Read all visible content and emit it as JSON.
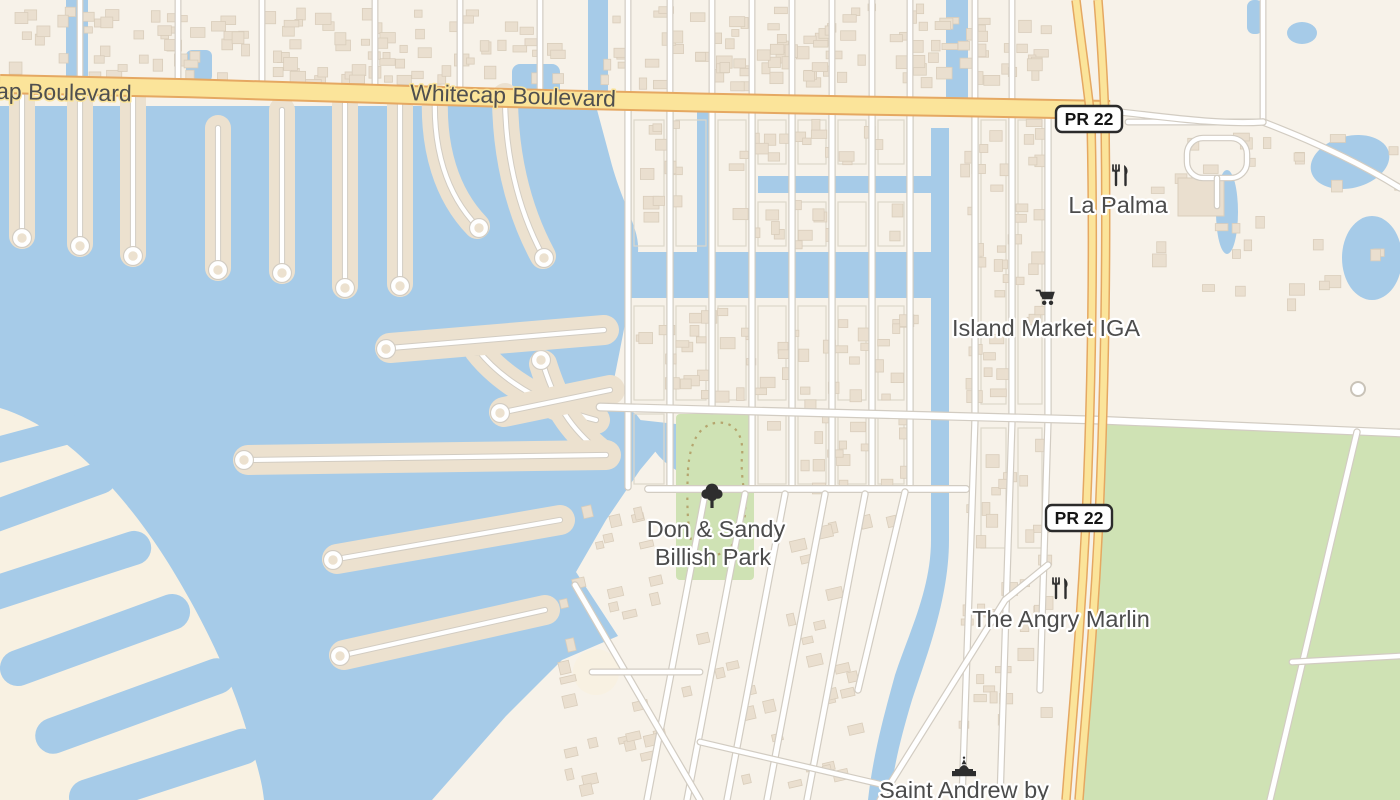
{
  "colors": {
    "water": "#a6cbe8",
    "wave": "#88aed2",
    "land": "#f7f2e9",
    "land_finger": "#ece1cf",
    "land_sand": "#f8f1e2",
    "building": "#eadfcf",
    "building_stroke": "#d9cdbb",
    "block_stroke": "#ddd7ca",
    "street": "#ffffff",
    "street_casing": "#d2ccc2",
    "highway": "#fbe49a",
    "highway_casing": "#e5a862",
    "green": "#cfe2b4",
    "trail": "#b09a62",
    "label": "#4c4c4c",
    "shield_bg": "#ffffff",
    "shield_border": "#2b2b2b",
    "icon": "#2e2e2e"
  },
  "street_labels": {
    "whitecap_partial": "ap Boulevard",
    "whitecap": "Whitecap Boulevard"
  },
  "route_shields": {
    "north": "PR 22",
    "south": "PR 22"
  },
  "pois": {
    "la_palma": {
      "name": "La Palma",
      "icon": "restaurant-icon"
    },
    "island_market": {
      "name": "Island Market IGA",
      "icon": "grocery-cart-icon"
    },
    "billish_park": {
      "name": "Don & Sandy Billish Park",
      "line1": "Don & Sandy",
      "line2": "Billish Park",
      "icon": "park-tree-icon"
    },
    "angry_marlin": {
      "name": "The Angry Marlin",
      "icon": "restaurant-icon"
    },
    "saint_andrew": {
      "name": "Saint Andrew by",
      "icon": "place-of-worship-icon"
    }
  }
}
